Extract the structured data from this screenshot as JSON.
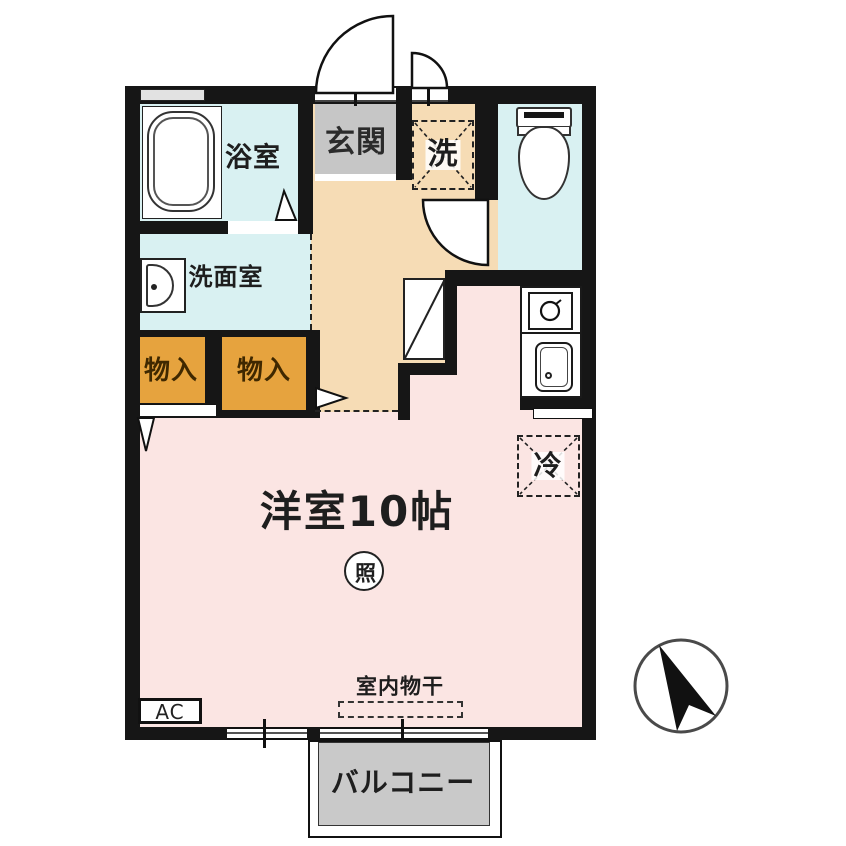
{
  "plan": {
    "title": "apartment-floor-plan",
    "rooms": {
      "bathroom": "浴室",
      "washroom": "洗面室",
      "entrance": "玄関",
      "washer": "洗",
      "closet": "物入",
      "main_room": "洋室10帖",
      "light": "照",
      "fridge": "冷",
      "ac": "AC",
      "indoor_drying": "室内物干",
      "balcony": "バルコニー"
    },
    "colors": {
      "wall": "#161616",
      "wet_area": "#D9F1F2",
      "entrance_gray": "#C6C6C6",
      "hallway_beige": "#F6DCB5",
      "closet_orange": "#E6A33E",
      "room_pink": "#FBE5E3",
      "balcony_gray": "#C9C9C9"
    }
  }
}
